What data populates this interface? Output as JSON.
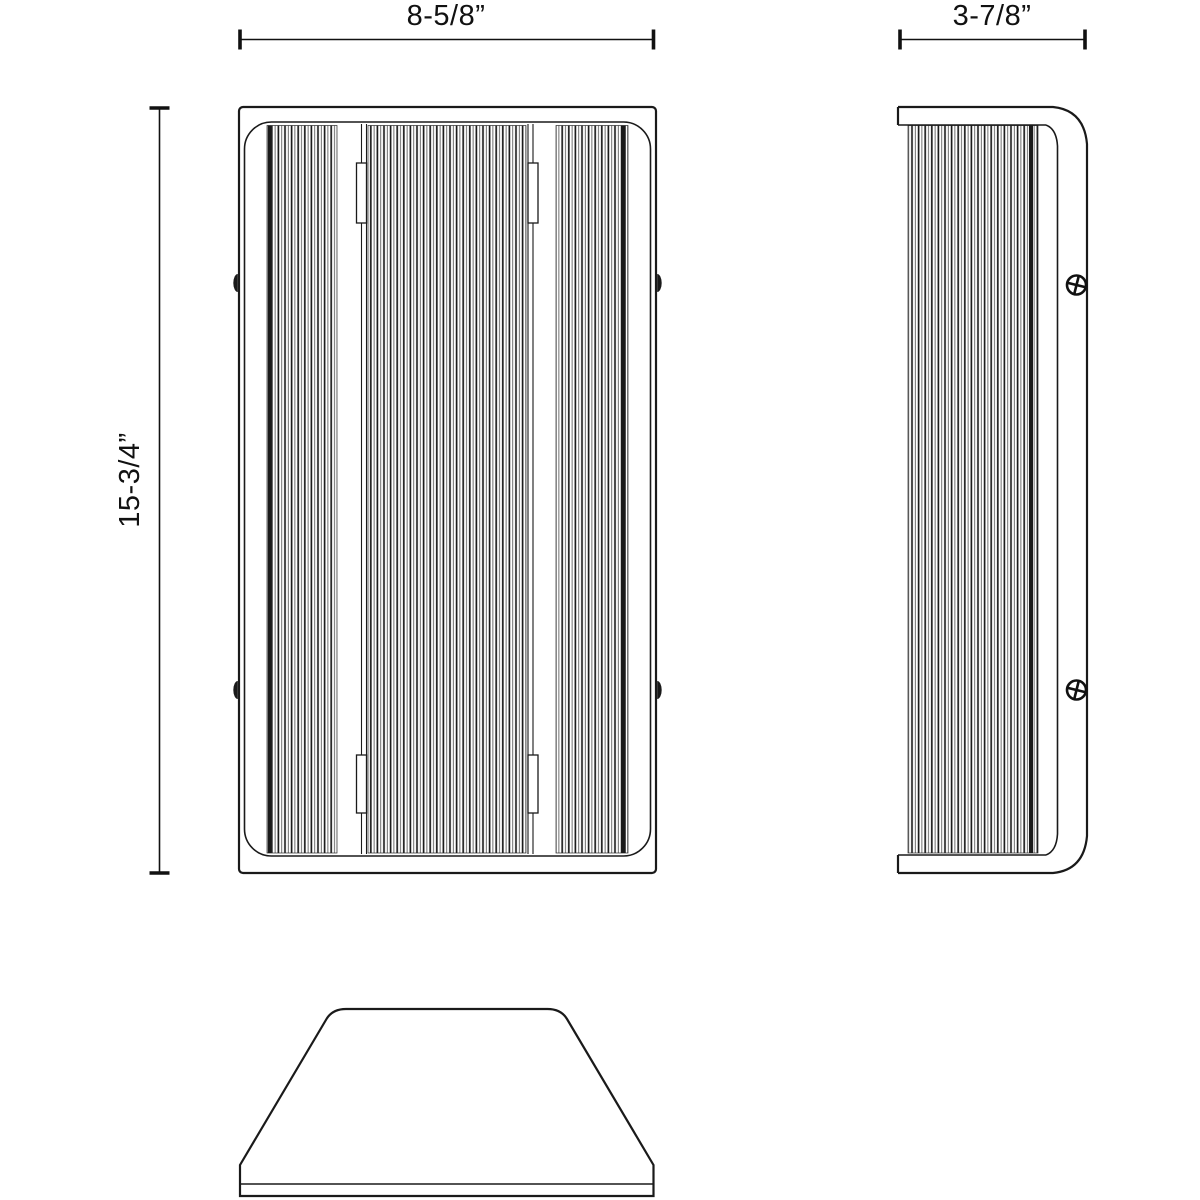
{
  "dimensions": {
    "front_width": {
      "label": "8-5/8”"
    },
    "side_depth": {
      "label": "3-7/8”"
    },
    "front_height": {
      "label": "15-3/4”"
    }
  },
  "colors": {
    "line": "#1a1a1a",
    "dimension": "#111111",
    "background": "#ffffff"
  }
}
